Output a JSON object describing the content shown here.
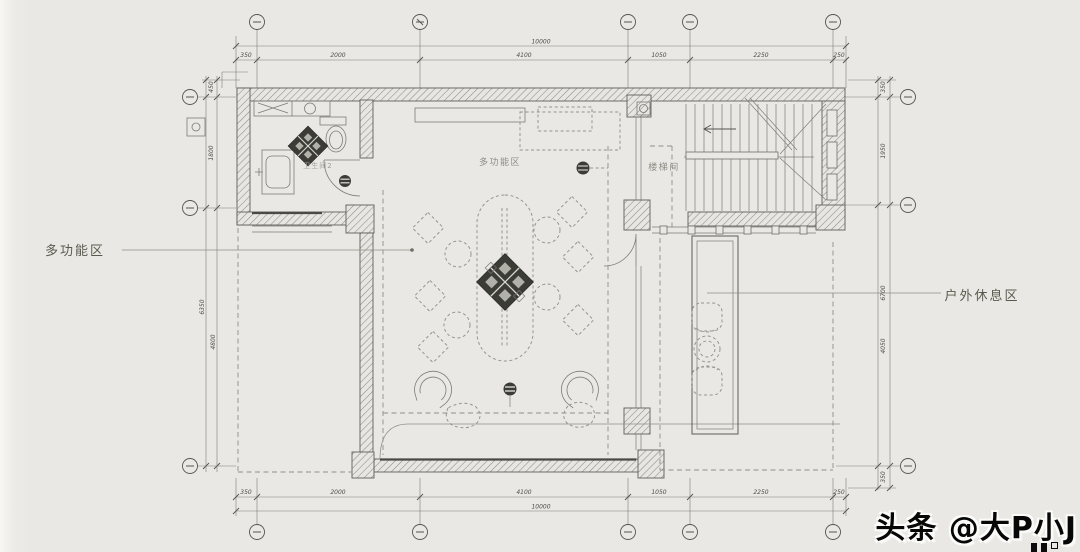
{
  "labels": {
    "left_callout": "多功能区",
    "right_callout": "户外休息区",
    "hall": "多功能区",
    "stairwell": "楼梯间",
    "bathroom": "卫生间2"
  },
  "dimensions": {
    "top": {
      "total": "10000",
      "segments": [
        "350",
        "2000",
        "4100",
        "1050",
        "2250",
        "250"
      ]
    },
    "bottom": {
      "total": "10000",
      "segments": [
        "350",
        "2000",
        "4100",
        "1050",
        "2250",
        "250"
      ]
    },
    "left": {
      "segments": [
        "450",
        "1800",
        "6350",
        "4800"
      ]
    },
    "right": {
      "segments": [
        "350",
        "1950",
        "6700",
        "4050",
        "350"
      ]
    }
  },
  "watermark": {
    "text": "头条 @大P小J"
  },
  "colors": {
    "background": "#e9e8e5",
    "drawing_line": "#6f6f69",
    "dark_fill": "#3c3c37",
    "callout_text": "#5a5a4c",
    "watermark_text": "#070707"
  }
}
